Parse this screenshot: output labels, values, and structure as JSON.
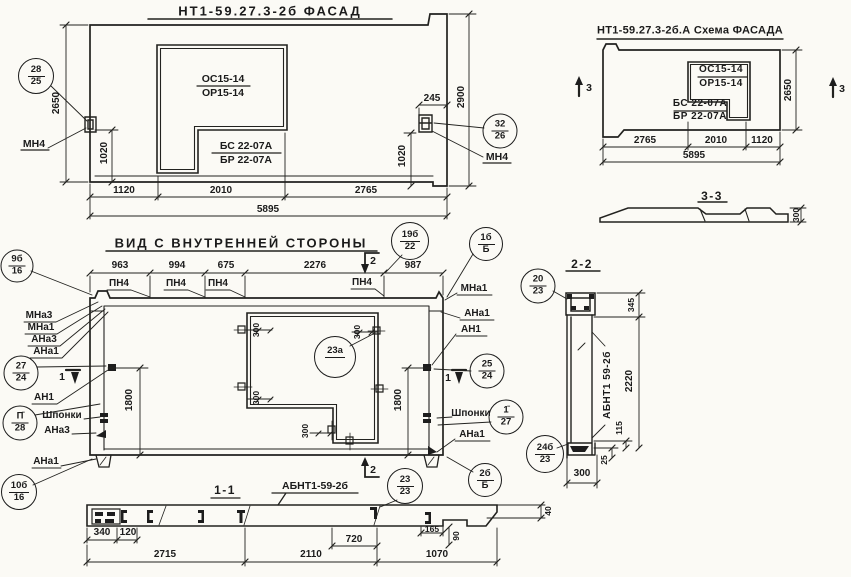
{
  "facade": {
    "title": "НТ1-59.27.3-2б ФАСАД",
    "opening_mark_top": "ОС15-14",
    "opening_mark_bot": "ОР15-14",
    "panel_mark_top": "БС 22-07А",
    "panel_mark_bot": "БР 22-07А",
    "anchor_left_label": "МН4",
    "anchor_right_label": "МН4",
    "callout_left": {
      "num": "28",
      "den": "25"
    },
    "callout_right": {
      "num": "32",
      "den": "26"
    },
    "dim_height_left": "2650",
    "dim_height_right": "2900",
    "dim_anchor_left": "1020",
    "dim_anchor_right": "1020",
    "dim_notch": "245",
    "dim_b1": "1120",
    "dim_b2": "2010",
    "dim_b3": "2765",
    "dim_total": "5895"
  },
  "schema": {
    "title": "НТ1-59.27.3-2б.А Схема ФАСАДА",
    "opening_mark_top": "ОС15-14",
    "opening_mark_bot": "ОР15-14",
    "panel_mark_top": "БС 22-07А",
    "panel_mark_bot": "БР 22-07А",
    "marker_left": "3",
    "marker_right": "3",
    "dim_height": "2650",
    "dim_b1": "2765",
    "dim_b2": "2010",
    "dim_b3": "1120",
    "dim_total": "5895",
    "section_title": "3-3",
    "section_thickness": "300"
  },
  "inner": {
    "title": "ВИД С ВНУТРЕННЕЙ СТОРОНЫ",
    "dim_t1": "963",
    "dim_t2": "994",
    "dim_t3": "675",
    "dim_t4": "2276",
    "dim_t5": "987",
    "pn1": "ПН4",
    "pn2": "ПН4",
    "pn3": "ПН4",
    "pn4": "ПН4",
    "left_stack": [
      "МНа3",
      "МНа1",
      "АНа3",
      "АНа1"
    ],
    "label_an1_left": "АН1",
    "label_shponki_left": "Шпонки",
    "label_ana3_left": "АНа3",
    "label_ana1_left": "АНа1",
    "label_mna1_right": "МНа1",
    "label_ana1_right_top": "АНа1",
    "label_an1_right": "АН1",
    "label_shponki_right": "Шпонки",
    "label_ana1_right_bot": "АНа1",
    "dim_height_left": "1800",
    "dim_height_right": "1800",
    "dim_o1": "300",
    "dim_o2": "300",
    "dim_o3": "300",
    "dim_o4": "300",
    "marker1_left": "1",
    "marker1_right": "1",
    "marker2_top": "2",
    "marker2_bot": "2",
    "callouts": {
      "c9b": {
        "num": "9б",
        "den": "16"
      },
      "c19b": {
        "num": "19б",
        "den": "22"
      },
      "c1b": {
        "num": "1б",
        "den": "Б"
      },
      "c27": {
        "num": "27",
        "den": "24"
      },
      "c28": {
        "num": "П̄",
        "den": "28"
      },
      "c23a": {
        "num": "23а",
        "den": ""
      },
      "c25": {
        "num": "25",
        "den": "24"
      },
      "c127": {
        "num": "1̄",
        "den": "27"
      },
      "c10b": {
        "num": "10б",
        "den": "16"
      }
    }
  },
  "sec1": {
    "title": "1-1",
    "beam_label": "АБНТ1-59-2б",
    "marker2": "2",
    "callout_2323": {
      "num": "23",
      "den": "23"
    },
    "callout_2bb": {
      "num": "2б",
      "den": "Б"
    },
    "d340": "340",
    "d120": "120",
    "d720": "720",
    "d2715": "2715",
    "d2110": "2110",
    "d1070": "1070",
    "d165": "165",
    "d90": "90",
    "d40": "40"
  },
  "sec2": {
    "title": "2-2",
    "beam_label": "АБНТ1 59-2б",
    "callout_top": {
      "num": "20",
      "den": "23"
    },
    "callout_bot": {
      "num": "24б",
      "den": "23"
    },
    "d345": "345",
    "d2220": "2220",
    "d115": "115",
    "d25": "25",
    "d300": "300"
  }
}
